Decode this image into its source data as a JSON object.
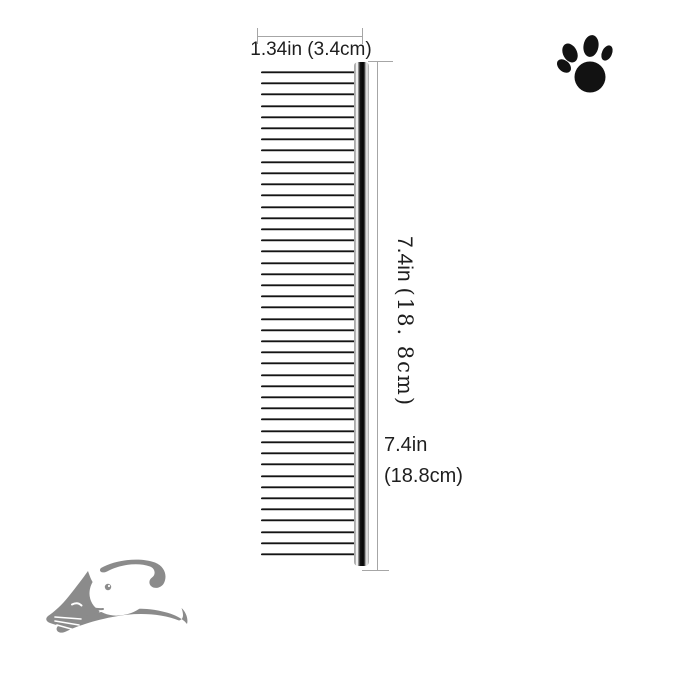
{
  "dimensions": {
    "width_label": "1.34in (3.4cm)",
    "side_label_in": "7.4in",
    "side_label_cm": "(18. 8cm)",
    "bottom_label_in": "7.4in",
    "bottom_label_cm": "(18.8cm)"
  },
  "comb": {
    "teeth_count": 44
  },
  "icons": {
    "paw_print": "black-paw-print",
    "brand_logo": "gray-dog-and-cat-silhouette"
  },
  "colors": {
    "background": "#ffffff",
    "text": "#1e1e1e",
    "dim_line": "#a6a6a6",
    "logo_gray": "#8b8b8b",
    "paw_black": "#121212"
  }
}
